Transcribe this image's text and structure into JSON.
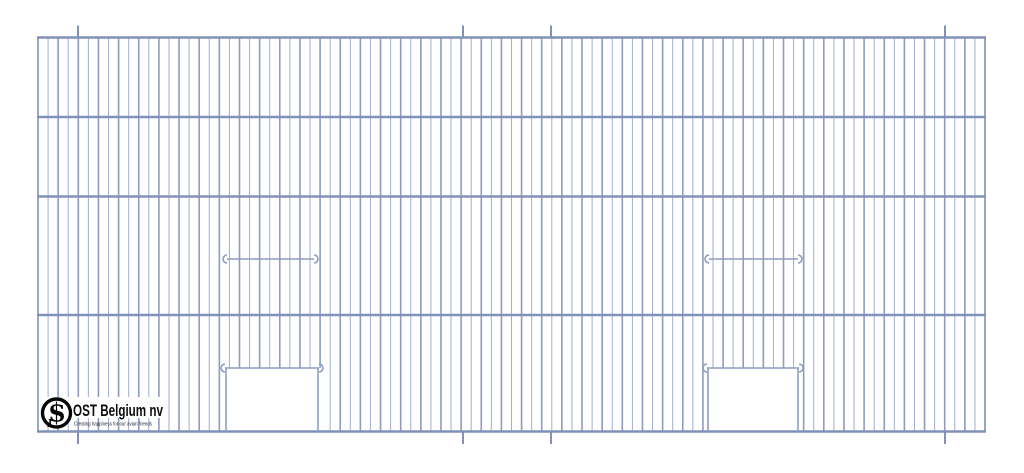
{
  "logo": {
    "name": "OST Belgium nv",
    "tagline": "Creating happiness for our avian friends",
    "monogram_letter": "S",
    "monogram_sub_letter": "J"
  },
  "drawing": {
    "background": "#ffffff",
    "wire_color": "#8d9cc0",
    "wire_color_thin": "#a0aecb",
    "rail_color": "#8191b8",
    "panel": {
      "x1": 38,
      "y1": 37.5,
      "x2": 985,
      "y2": 431.5
    },
    "wire_count": 95,
    "rails_y": [
      37.5,
      117,
      196.5,
      315,
      431.5
    ],
    "hanger_ticks_x": [
      78,
      463,
      551,
      945
    ],
    "tick_top_y": 25.5,
    "tick_bottom_y": 444,
    "doors": [
      {
        "x1": 226,
        "x2": 318
      },
      {
        "x1": 708,
        "x2": 798
      }
    ],
    "door_bar_y": 368,
    "perches": [
      {
        "x1": 219,
        "x2": 322
      },
      {
        "x1": 701,
        "x2": 806
      }
    ],
    "perch_y": 259
  }
}
